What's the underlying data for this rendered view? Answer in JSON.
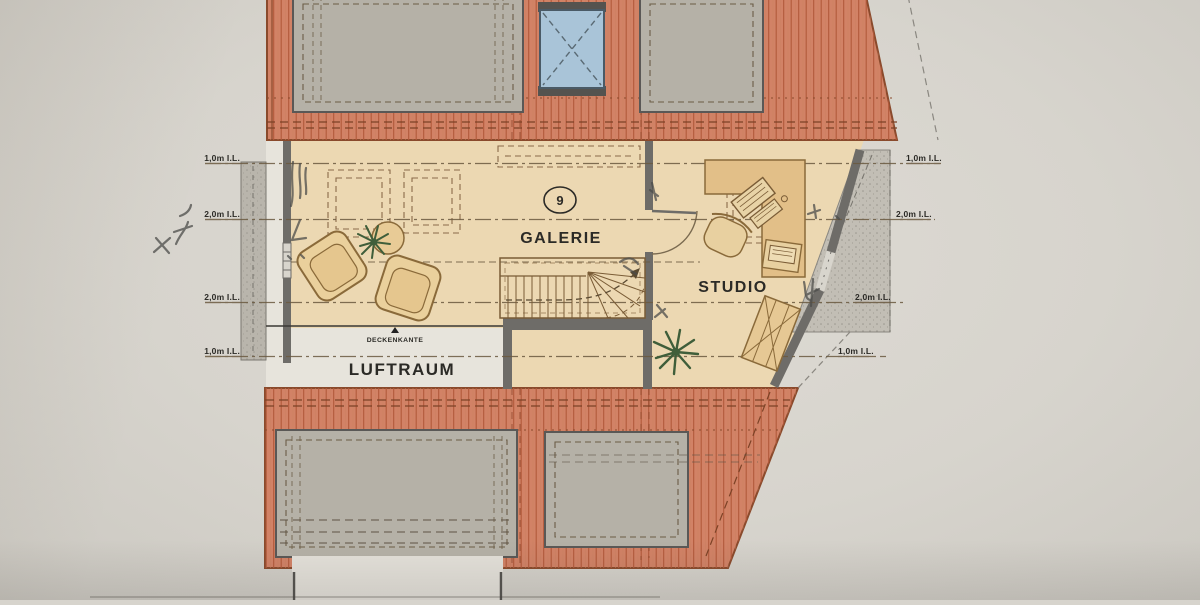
{
  "plan": {
    "rooms": {
      "galerie": "GALERIE",
      "studio": "STUDIO",
      "luftraum": "LUFTRAUM"
    },
    "annotations": {
      "deckenkante": "DECKENKANTE",
      "stair_number": "9"
    },
    "dimensions_left": [
      "1,0m I.L.",
      "2,0m I.L.",
      "2,0m I.L.",
      "1,0m I.L."
    ],
    "dimensions_right": [
      "1,0m I.L.",
      "2,0m I.L.",
      "2,0m I.L.",
      "1,0m I.L."
    ],
    "colors": {
      "roof": "#d28266",
      "roof_hatch": "#b2593a",
      "floor": "#ecd8b2",
      "desk": "#e2bf88",
      "furniture": "#e9d09c",
      "dormer_gray": "#b5b1a7",
      "zone_gray": "#c2beb5",
      "skylight_blue": "#a9c4d8",
      "wall": "#6e6c68",
      "void_white": "#e7e4dc",
      "plant_green": "#3f5e3a",
      "pencil": "#4c4c4a"
    }
  }
}
